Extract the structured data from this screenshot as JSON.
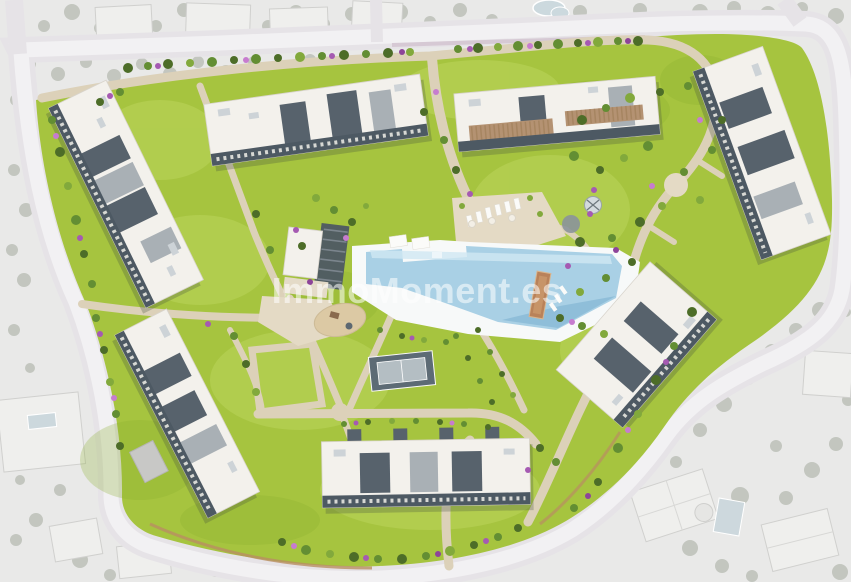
{
  "meta": {
    "description": "Aerial 3D render site plan of a residential complex; colored development surrounded by desaturated neighborhood"
  },
  "watermark": {
    "text": "ImmoMoment.es"
  },
  "scene": {
    "buildings": [
      "block-northwest",
      "block-north",
      "block-northeast",
      "block-east-upper",
      "block-east-lower",
      "block-west",
      "block-south"
    ],
    "amenities": [
      "swimming-pool",
      "pool-deck",
      "clubhouse-pergola",
      "multisport-court",
      "petanque-track",
      "playground",
      "sun-loungers",
      "garden-paths"
    ]
  },
  "palette": {
    "bg": "#e9e9e8",
    "road": "#e6e3e7",
    "road-center": "#f2f1f3",
    "grass": "#a6c43f",
    "grass-light": "#bdd65e",
    "grass-dark": "#88ad2f",
    "path": "#dcd1b9",
    "plaza": "#e4dac5",
    "roof": "#f3f1ec",
    "roof-edge": "#d8d4cc",
    "roof-dark": "#57626c",
    "roof-mid": "#a9b0b5",
    "facade": "#4d5963",
    "pergola": "#b49272",
    "pool-deck": "#f7f9f9",
    "pool-water": "#a9d0e5",
    "pool-water-light": "#cfe7f2",
    "pool-water-dark": "#7fb2d0",
    "court": "#5d6b75",
    "court-inner": "#b4bec3",
    "track": "#b9825a",
    "sand": "#dcc9a4",
    "tree-dark": "#4d6d28",
    "tree-mid": "#638e33",
    "tree-light": "#82a93c",
    "bush-a": "#a55ab2",
    "bush-b": "#c77ccf",
    "bush-c": "#8d4499",
    "gray-tree": "#b3b8ae",
    "wall": "#b98f63",
    "wall-north": "#d6c9d4",
    "watermark": "rgba(255,255,255,0.55)"
  }
}
